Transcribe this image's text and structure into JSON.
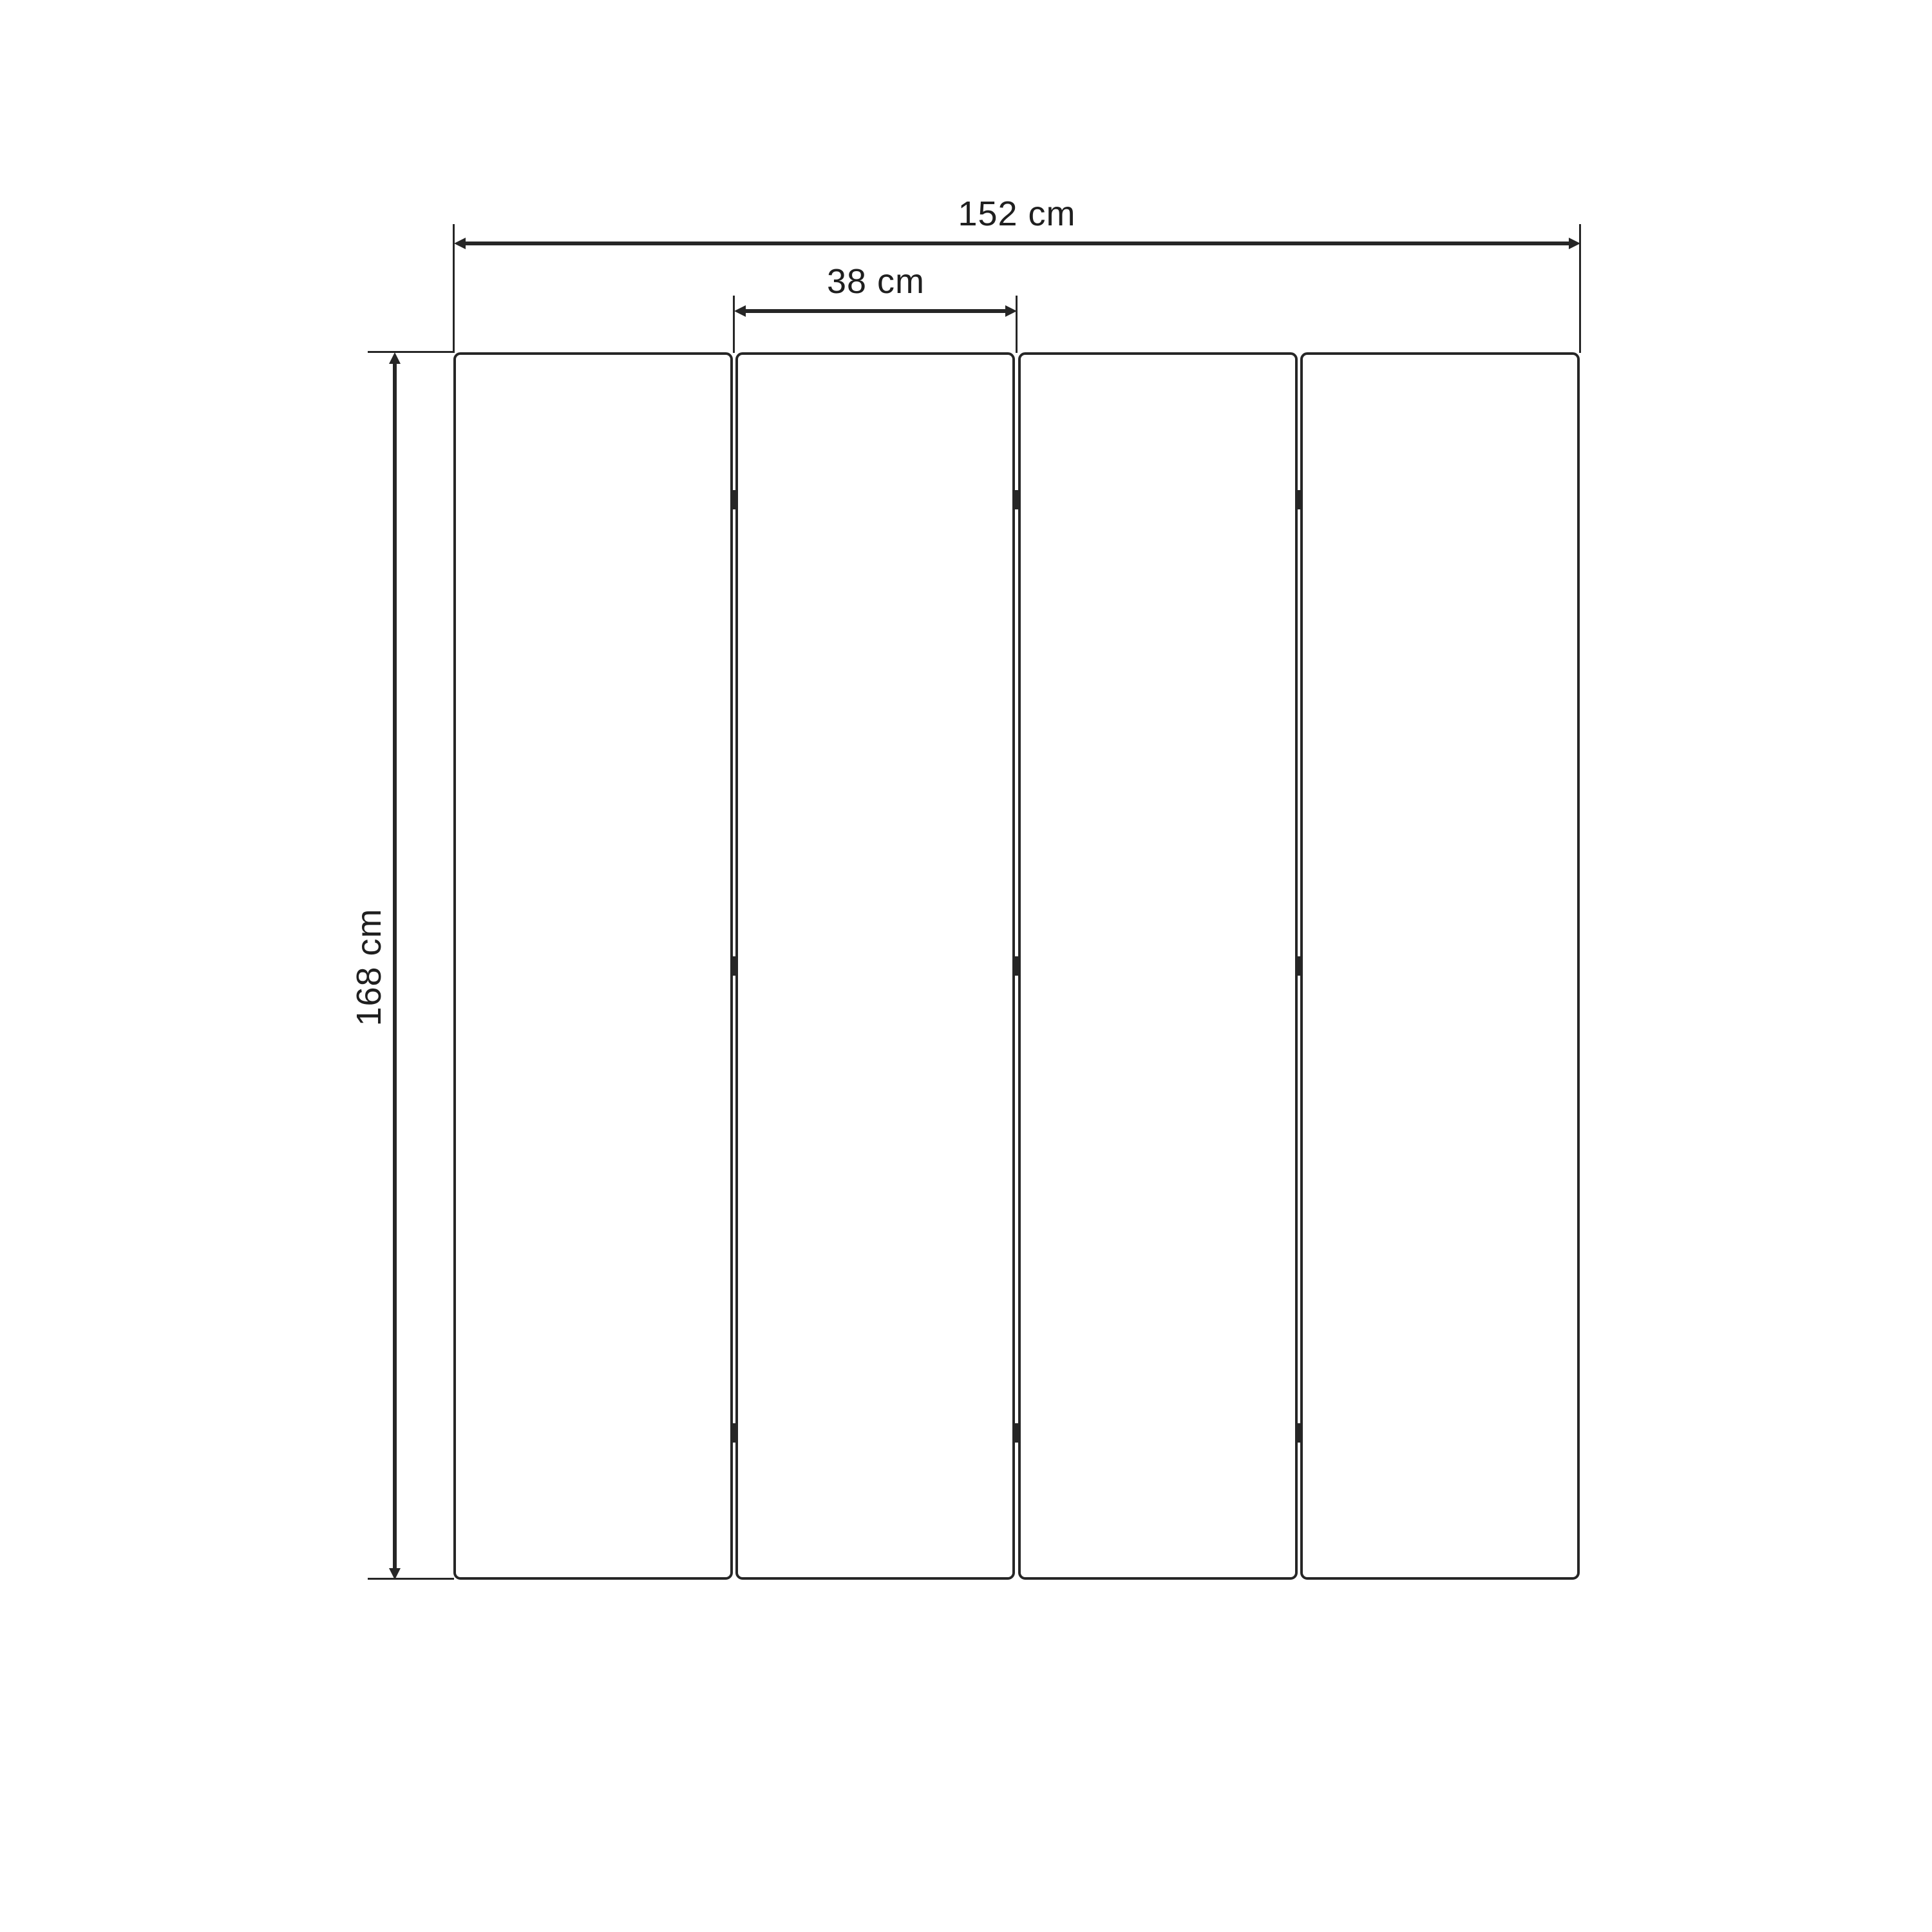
{
  "diagram": {
    "title": "four-panel-room-divider-dimension-drawing",
    "panel_count": 4,
    "joint_count": 3,
    "hinges_per_joint": 3,
    "dimensions": {
      "total_width": {
        "label": "152 cm",
        "value": 152,
        "unit": "cm",
        "orientation": "horizontal"
      },
      "panel_width": {
        "label": "38 cm",
        "value": 38,
        "unit": "cm",
        "orientation": "horizontal"
      },
      "height": {
        "label": "168 cm",
        "value": 168,
        "unit": "cm",
        "orientation": "vertical"
      }
    },
    "colors": {
      "line": "#262626",
      "text": "#1f1f1f",
      "panel_fill": "#ffffff",
      "background": "#ffffff"
    }
  }
}
